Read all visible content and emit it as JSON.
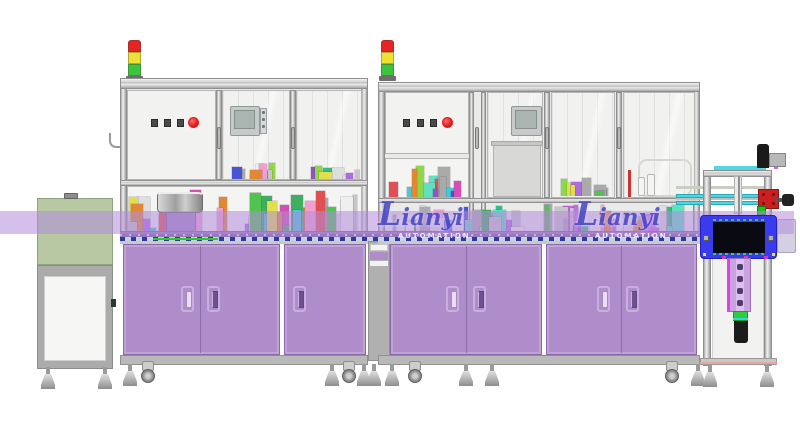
{
  "scene": {
    "label": "Automated assembly line - CAD render",
    "width": 800,
    "height": 438
  },
  "watermarks": [
    {
      "brand": "Lianyi",
      "tagline": "AUTOMATION"
    },
    {
      "brand": "Lianyi",
      "tagline": "AUTOMATION"
    }
  ],
  "colors": {
    "background": "#ffffff",
    "cabinet_purple": "#ae8dca",
    "band_purple": "rgba(178,140,220,0.55)",
    "bar_purple": "#9678be",
    "hood_green": "#b7c8a3",
    "unit_blue": "#3b3bee",
    "rail_cyan": "#4ed6e2",
    "stack_red": "#e62424",
    "stack_yellow": "#efe133",
    "stack_green": "#3cc43c",
    "estop_red": "#e01c22",
    "button_dark": "#4a4a4a",
    "watermark_blue": "#4545c5",
    "column_purple": "#c9a2e2",
    "green_band": "#2ecc40",
    "green_line": "#27cc27"
  },
  "stack_lights": [
    {
      "machine": "machine-1",
      "segments": [
        "red",
        "yellow",
        "green"
      ]
    },
    {
      "machine": "machine-2",
      "segments": [
        "red",
        "yellow",
        "green"
      ]
    }
  ],
  "control_panels": [
    {
      "machine": "machine-1",
      "square_buttons": 3,
      "estop_buttons": 1
    },
    {
      "machine": "machine-2",
      "square_buttons": 3,
      "estop_buttons": 1
    }
  ],
  "clutter": {
    "palette": [
      "#c36ee0",
      "#9550c8",
      "#4fc44f",
      "#2fbf7f",
      "#e2e04a",
      "#45c8d8",
      "#e05050",
      "#4854d4",
      "#e08834",
      "#d34fb4",
      "#8fd845",
      "#f0a0d0",
      "#60e0c0",
      "#b06ae0",
      "#3fae5f"
    ],
    "grays": [
      "#c6c6c6",
      "#dedede",
      "#aaaaaa",
      "#efefef"
    ],
    "strips": [
      {
        "name": "m1-w2-strip",
        "seed": 3,
        "count": 10
      },
      {
        "name": "m1-w3-strip",
        "seed": 5,
        "count": 8
      },
      {
        "name": "m1-lower-strip",
        "seed": 7,
        "count": 46
      },
      {
        "name": "m2-subpanel-strip",
        "seed": 11,
        "count": 16
      },
      {
        "name": "m2-w3-strip",
        "seed": 9,
        "count": 9
      },
      {
        "name": "m2-lower-strip",
        "seed": 13,
        "count": 60
      }
    ]
  }
}
